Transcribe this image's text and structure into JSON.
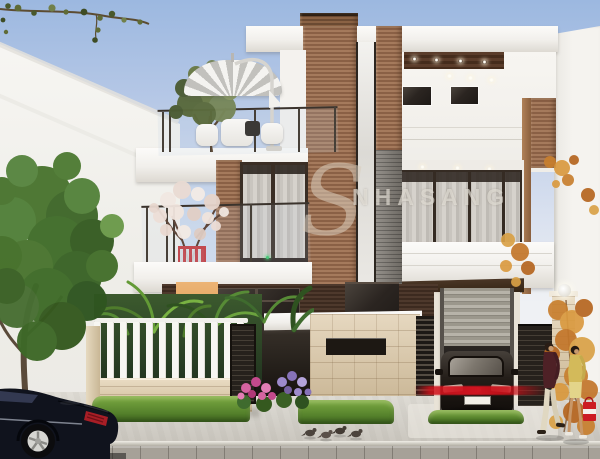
{
  "scene": {
    "watermark": {
      "logo_letter": "S",
      "text": "NHASANG"
    },
    "objects": [
      "house",
      "rooftop-terrace-umbrella",
      "terrace-tree",
      "blossom-tree",
      "left-street-tree",
      "autumn-tree",
      "white-picket-fence",
      "stone-fence-wall",
      "entrance-stone-wall",
      "roller-shutter-garage",
      "parked-sedan-in-garage",
      "street-sedan",
      "pedestrian-man",
      "pedestrian-woman",
      "shopping-bag",
      "pigeons",
      "pillar-lamp"
    ]
  },
  "palette": {
    "sky_top": "#9cb8e0",
    "sky_bottom": "#eff1f4",
    "wall_white": "#f4f2ee",
    "wood_light": "#a57a5c",
    "wood_mid": "#8a6045",
    "wood_dark": "#3c2a1f",
    "glass_dark": "#2b2521",
    "curtain_gray": "#cbc7c1",
    "stone_beige": "#dccdb5",
    "fence_white": "#f6f5f1",
    "foliage_green": "#4a7530",
    "foliage_autumn": "#c87f2e",
    "blossom_pink": "#eadbd3",
    "flower_pink": "#d563a0",
    "flower_purple": "#9d8acb",
    "hedge_green": "#6f9e3c",
    "road_gray": "#d2cfc8",
    "curb_gray": "#a6a198",
    "red_streak": "#d01420",
    "sedan_navy": "#10131d",
    "bag_red": "#cc1c22",
    "outfit_yellow": "#d3ba5a",
    "shirt_maroon": "#4e2126"
  }
}
